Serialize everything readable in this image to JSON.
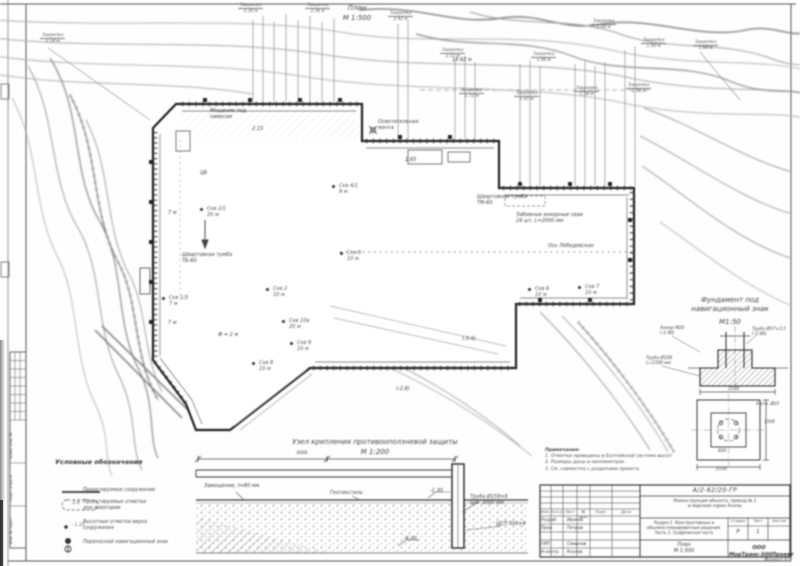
{
  "page": {
    "title": "План\nМ 1:500",
    "format_label": "Формат А3"
  },
  "plan": {
    "labels": [
      {
        "text": "Мощение под\nнавесом",
        "x": 210,
        "y": 108
      },
      {
        "text": "Осветительная\nмачта",
        "x": 378,
        "y": 119
      },
      {
        "text": "Швартовная тумба\nТМ-60",
        "x": 477,
        "y": 194
      },
      {
        "text": "Забивные анкерные сваи\n24 шт, L=2000 мм",
        "x": 516,
        "y": 212
      },
      {
        "text": "Швартовная тумба\nТБ-60",
        "x": 182,
        "y": 252
      },
      {
        "text": "Ось Лебедевская",
        "x": 548,
        "y": 243
      },
      {
        "text": "7 м",
        "x": 168,
        "y": 210
      },
      {
        "text": "7 м",
        "x": 168,
        "y": 320
      },
      {
        "text": "ЦБ",
        "x": 200,
        "y": 170
      },
      {
        "text": "2.15",
        "x": 252,
        "y": 126
      },
      {
        "text": "1.85",
        "x": 405,
        "y": 157
      },
      {
        "text": "(-2.8)",
        "x": 396,
        "y": 386
      },
      {
        "text": "(-3.4)",
        "x": 462,
        "y": 336
      },
      {
        "text": "18.62 м",
        "x": 452,
        "y": 57
      },
      {
        "text": "Ф = 2 м",
        "x": 218,
        "y": 332
      }
    ],
    "boreholes": [
      {
        "name": "Скв 2/1",
        "depth": "20 м",
        "x": 200,
        "y": 206
      },
      {
        "name": "Скв 4/1",
        "depth": "9 м",
        "x": 332,
        "y": 183
      },
      {
        "name": "Скв 5",
        "depth": "10 м",
        "x": 340,
        "y": 250
      },
      {
        "name": "Скв 2",
        "depth": "10 м",
        "x": 266,
        "y": 286
      },
      {
        "name": "Скв 10а",
        "depth": "20 м",
        "x": 282,
        "y": 318
      },
      {
        "name": "Скв 9",
        "depth": "10 м",
        "x": 290,
        "y": 340
      },
      {
        "name": "Скв 8",
        "depth": "10 м",
        "x": 252,
        "y": 360
      },
      {
        "name": "Скв 6",
        "depth": "10 м",
        "x": 528,
        "y": 286
      },
      {
        "name": "Скв 7",
        "depth": "10 м",
        "x": 578,
        "y": 284
      },
      {
        "name": "Скв 1/3",
        "depth": "7 м",
        "x": 162,
        "y": 295
      }
    ],
    "callouts": [
      {
        "t": "Закрепка",
        "v": "2.14 м",
        "x": 40,
        "y": 33
      },
      {
        "t": "Закрепка",
        "v": "2.30 м",
        "x": 238,
        "y": 3
      },
      {
        "t": "Закрепка",
        "v": "2.36 м",
        "x": 305,
        "y": 3
      },
      {
        "t": "Закрепка",
        "v": "2.42 м",
        "x": 388,
        "y": 11
      },
      {
        "t": "Закрепка",
        "v": "2.15 м",
        "x": 440,
        "y": 48
      },
      {
        "t": "Закрепка",
        "v": "1.96 м",
        "x": 531,
        "y": 52
      },
      {
        "t": "Закрепка",
        "v": "2.08 м",
        "x": 591,
        "y": 19
      },
      {
        "t": "Закрепка",
        "v": "1.90 м",
        "x": 641,
        "y": 38
      },
      {
        "t": "Закрепка",
        "v": "1.84 м",
        "x": 693,
        "y": 40
      },
      {
        "t": "Закрепка",
        "v": "1.72 м",
        "x": 459,
        "y": 88
      },
      {
        "t": "Закрепка",
        "v": "1.65 м",
        "x": 514,
        "y": 91
      },
      {
        "t": "Закрепка",
        "v": "1.58 м",
        "x": 574,
        "y": 86
      },
      {
        "t": "Закрепка",
        "v": "1.50 м",
        "x": 626,
        "y": 83
      }
    ]
  },
  "legend": {
    "title": "Условные обозначения",
    "items": [
      {
        "label": "Проектируемое сооружение"
      },
      {
        "label": "Проектируемые отметки\nдна акватории",
        "symbol_text": "-2.8"
      },
      {
        "label": "Высотные отметки верха\nсооружения",
        "symbol_text": "– 1.25"
      },
      {
        "label": "Переносной навигационный знак"
      }
    ]
  },
  "notes": {
    "title": "Примечания:",
    "lines": [
      "1. Отметки приведены в Балтийской системе высот.",
      "2. Размеры даны в миллиметрах.",
      "3. См. совместно с разделами проекта."
    ]
  },
  "detail_section": {
    "title": "Узел крепления противооползневой защиты",
    "scale": "М 1:200",
    "dim_top": "3000",
    "labels": [
      {
        "text": "Замощение, t=80 мм",
        "x": 204,
        "y": 483
      },
      {
        "text": "Геотекстиль",
        "x": 330,
        "y": 490
      },
      {
        "text": "-1.30",
        "x": 430,
        "y": 488
      },
      {
        "text": "Труба Ø159×6\nшаг 3000 мм",
        "x": 470,
        "y": 494
      },
      {
        "text": "ЦСП 500×6",
        "x": 496,
        "y": 521
      },
      {
        "text": "-6.00",
        "x": 404,
        "y": 536
      }
    ]
  },
  "detail_foundation": {
    "title": "Фундамент под\nнавигационный знак",
    "scale": "М1:50",
    "labels": [
      {
        "text": "Анкер М20\n(-2.40)",
        "x": 660,
        "y": 326
      },
      {
        "text": "Труба Ø57×3.5\n(-2.90)",
        "x": 752,
        "y": 327
      },
      {
        "text": "Труба Ø108\nL=1500 мм",
        "x": 646,
        "y": 356
      },
      {
        "text": "2100",
        "x": 728,
        "y": 387
      },
      {
        "text": "4 отв. Ø25",
        "x": 756,
        "y": 402
      },
      {
        "text": "600",
        "x": 718,
        "y": 449
      },
      {
        "text": "2100",
        "x": 716,
        "y": 467
      },
      {
        "text": "1500",
        "x": 764,
        "y": 420
      }
    ]
  },
  "titleblock": {
    "code": "А/2-62/20-ГР",
    "object": "Реконструкция объекта, проезд № 1\nв морском парке Анапы",
    "section_title": "Раздел 1. Конструктивные и\nобъемно-планировочные решения.\nЧасть 1. Графическая часть",
    "stage_label": "Стадия",
    "sheet_label": "Лист",
    "sheets_label": "Листов",
    "stage": "Р",
    "sheet": "1",
    "drawing_name": "План\nМ 1:500",
    "company": "ООО МорТранс-500Проект",
    "header_cols": [
      "Изм.",
      "Кол.уч",
      "Лист",
      "№ док.",
      "Подп.",
      "Дата"
    ],
    "sig_rows": [
      {
        "role": "Разраб.",
        "name": "Иванов"
      },
      {
        "role": "Пров.",
        "name": "Петров"
      },
      {
        "role": "",
        "name": ""
      },
      {
        "role": "ГИП",
        "name": "Смирнов"
      },
      {
        "role": "Н.контр.",
        "name": "Козлов"
      }
    ]
  },
  "side_strip": {
    "labels": [
      "Взам. инв. №",
      "Подп. и дата",
      "Инв. № подл."
    ]
  }
}
